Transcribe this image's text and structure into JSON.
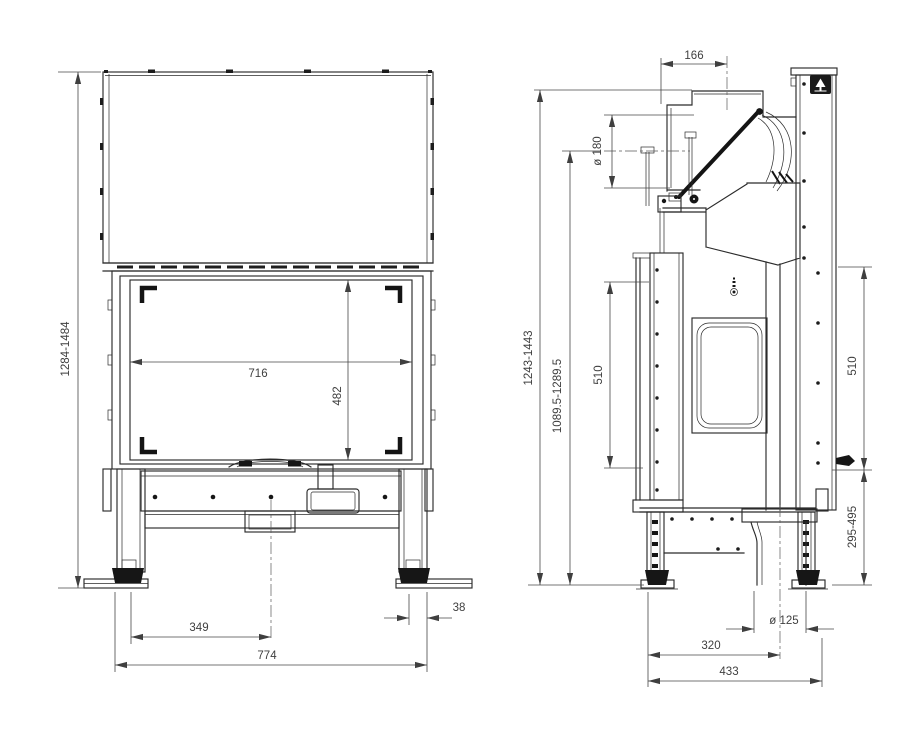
{
  "front_view": {
    "overall_height": "1284-1484",
    "glass_width": "716",
    "glass_height": "482",
    "center_to_leg": "349",
    "overall_width": "774",
    "foot_offset": "38"
  },
  "side_view": {
    "flue_center_offset": "166",
    "flue_diameter": "ø 180",
    "flue_top_height": "1243-1443",
    "flue_center_height": "1089.5-1289.5",
    "door_height": "510",
    "rear_panel_height": "510",
    "base_clearance": "295-495",
    "air_inlet_diameter": "ø 125",
    "air_inlet_center": "320",
    "overall_depth": "433"
  }
}
